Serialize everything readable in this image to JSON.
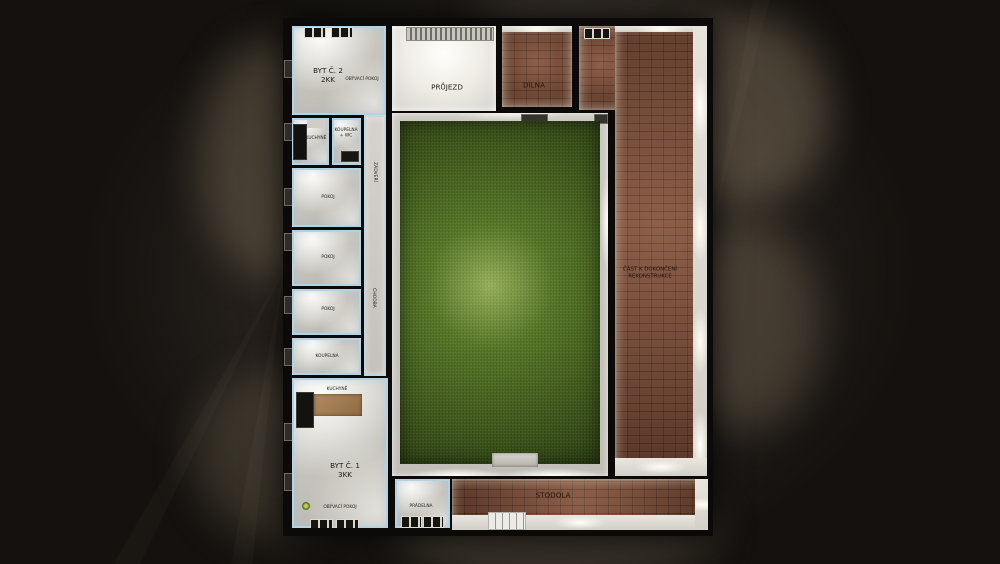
{
  "building": {
    "byt2": {
      "title": "BYT Č. 2",
      "subtitle": "2KK",
      "living": "OBÝVACÍ POKOJ",
      "kitchen": "KUCHYNĚ",
      "bath_line1": "KOUPELNA",
      "bath_line2": "+ WC"
    },
    "bedrooms": [
      "POKOJ",
      "POKOJ",
      "POKOJ"
    ],
    "bathroom2": "KOUPELNA",
    "hall": {
      "top": "ZÁDVEŘÍ",
      "main": "CHODBA"
    },
    "prujezd": "PRŮJEZD",
    "dilna": "DÍLNA",
    "right_wing": {
      "line1": "ČÁST K DOKONČENÍ",
      "line2": "REKONSTRUKCE"
    },
    "stodola": "STODOLA",
    "byt1": {
      "title": "BYT Č. 1",
      "subtitle": "3KK",
      "kitchen": "KUCHYNĚ",
      "living": "OBÝVACÍ POKOJ",
      "laundry": "PRÁDELNA"
    }
  },
  "colors": {
    "background": "#14110e",
    "walls": "#0b0a08",
    "floor_light": "#d2cfc8",
    "wall_accent_blue": "#b3d2e2",
    "brick": "#7b4a36",
    "grass": "#48661f",
    "grass_highlight": "#a8c465"
  }
}
